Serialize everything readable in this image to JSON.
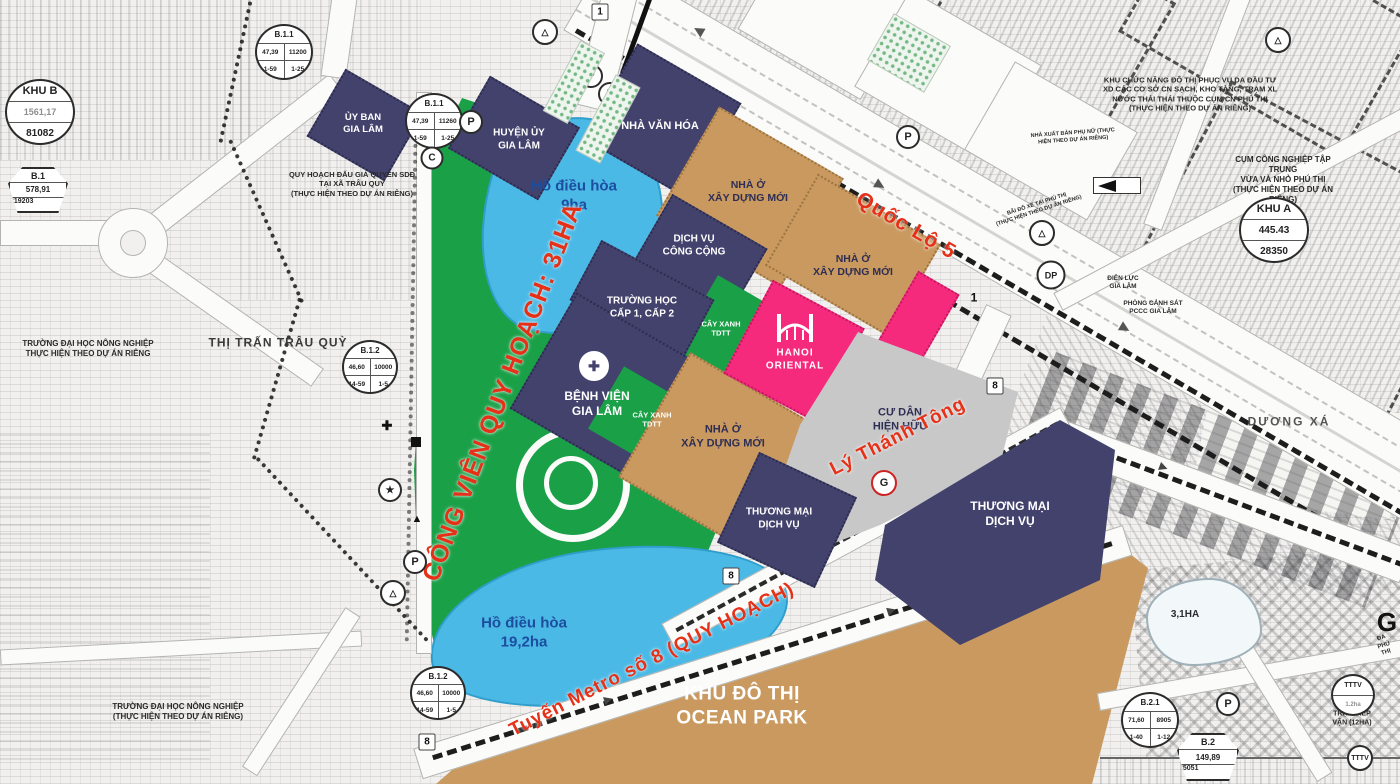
{
  "zones": {
    "uy_ban": "ỦY BAN\nGIA LÂM",
    "huyen_uy": "HUYỆN ỦY\nGIA LÂM",
    "nha_van_hoa": "NHÀ VĂN HÓA",
    "nha_o_moi": "NHÀ Ở\nXÂY DỰNG MỚI",
    "dich_vu_cong_cong": "DỊCH VỤ\nCÔNG CỘNG",
    "truong_hoc": "TRƯỜNG HỌC\nCẤP 1, CẤP 2",
    "benh_vien": "BỆNH VIỆN\nGIA LÂM",
    "cay_xanh_tdtt": "CÂY XANH\nTDTT",
    "hanoi_oriental": "HANOI\nORIENTAL",
    "cu_dan_hien_huu": "CƯ DÂN\nHIỆN HỮU",
    "thuong_mai_dich_vu": "THƯƠNG MẠI\nDỊCH VỤ",
    "khu_do_thi_ocean_park": "KHU ĐÔ THỊ\nOCEAN PARK"
  },
  "lakes": {
    "ho_dieu_hoa_9": "Hồ điều hòa\n9ha",
    "ho_dieu_hoa_19": "Hồ điều hòa\n19,2ha",
    "lake_3_1": "3,1HA"
  },
  "roads": {
    "quoc_lo_5": "Quốc Lộ 5",
    "ly_thanh_tong": "Lý Thánh Tông",
    "metro_8": "Tuyến Metro số 8 (QUY HOẠCH)",
    "cong_vien": "CÔNG VIÊN QUY HOẠCH: 31HA"
  },
  "areas": {
    "thi_tran_trau_quy": "THỊ TRẤN TRÂU QUỲ",
    "duong_xa": "DƯƠNG XÁ",
    "truong_dai_hoc_1": "TRƯỜNG ĐẠI HỌC NÔNG NGHIỆP\nTHỰC HIỆN THEO DỰ ÁN RIÊNG",
    "truong_dai_hoc_2": "TRƯỜNG ĐẠI HỌC NÔNG NGHIỆP\n(THỰC HIỆN THEO DỰ ÁN RIÊNG)",
    "quy_hoach_dau_gia": "QUY HOẠCH ĐẤU GIÁ QUYỀN SDĐ\nTẠI XÃ TRÂU QUỲ\n(THỰC HIỆN THEO DỰ ÁN RIÊNG)",
    "khu_chuc_nang": "KHU CHỨC NĂNG ĐÔ THỊ PHỤC VỤ DA ĐẦU TƯ\nXD CÁC CƠ SỞ CN SẠCH, KHO TÀNG, TRẠM XL\nNƯỚC THẢI THÁI THUỘC CỤM CN PHÚ THỊ\n(THỰC HIỆN THEO DỰ ÁN RIÊNG)",
    "cum_cong_nghiep": "CỤM CÔNG NGHIỆP TẬP TRUNG\nVỪA VÀ NHỎ PHÚ THỊ\n(THỰC HIỆN THEO DỰ ÁN RIÊNG)",
    "nha_xuat_ban": "NHÀ XUẤT BẢN PHỤ NỮ (THỰC\nHIỆN THEO DỰ ÁN RIÊNG)",
    "bai_do_xe": "BÃI ĐỖ XE TẠI PHÚ THỊ\n(THỰC HIỆN THEO DỰ ÁN RIÊNG)",
    "dien_luc": "ĐIỆN LỰC\nGIA LÂM",
    "phong_canh_sat": "PHÒNG CẢNH SÁT\nPCCC GIA LÂM",
    "tram_tiep_van": "TRẠM TIẾP VẬN (12HA)",
    "da_phu_thi": "ĐA PHÚ THỊ",
    "g_label": "G"
  },
  "badges": {
    "khu_b": {
      "name": "KHU B",
      "v1": "1561,17",
      "v2": "81082"
    },
    "khu_a": {
      "name": "KHU A",
      "v1": "445.43",
      "v2": "28350"
    },
    "b1": {
      "name": "B.1",
      "v1": "578,91",
      "v2": "31920",
      "v3": "3"
    },
    "b11": {
      "name": "B.1.1",
      "a": "47,39",
      "b": "11200",
      "c": "1-59",
      "d": "1-25"
    },
    "b11b": {
      "name": "B.1.1",
      "a": "47,39",
      "b": "11260",
      "c": "1-59",
      "d": "1-25"
    },
    "b12": {
      "name": "B.1.2",
      "a": "46,60",
      "b": "10000",
      "c": "14-59",
      "d": "1-5"
    },
    "b21": {
      "name": "B.2.1",
      "a": "71,60",
      "b": "8905",
      "c": "1-40",
      "d": "1-12"
    },
    "b2": {
      "name": "B.2",
      "v1": "149,89",
      "v2": "8505",
      "v3": "1"
    },
    "tttv": {
      "name": "TTTV",
      "v1": "1.2ha"
    }
  },
  "markers": {
    "p": "P",
    "c": "C",
    "dp": "DP",
    "g": "G",
    "r1": "1",
    "r8": "8",
    "star": "★",
    "tri": "▲",
    "cross": "✚",
    "sym": "△"
  },
  "colors": {
    "navy": "#42426d",
    "tan": "#c9995f",
    "pink": "#f62a7c",
    "green": "#1aa047",
    "lake": "#4ab9e6",
    "gray": "#c8c8c9",
    "red_label": "#e63119",
    "blue_label": "#1c4d9f"
  }
}
